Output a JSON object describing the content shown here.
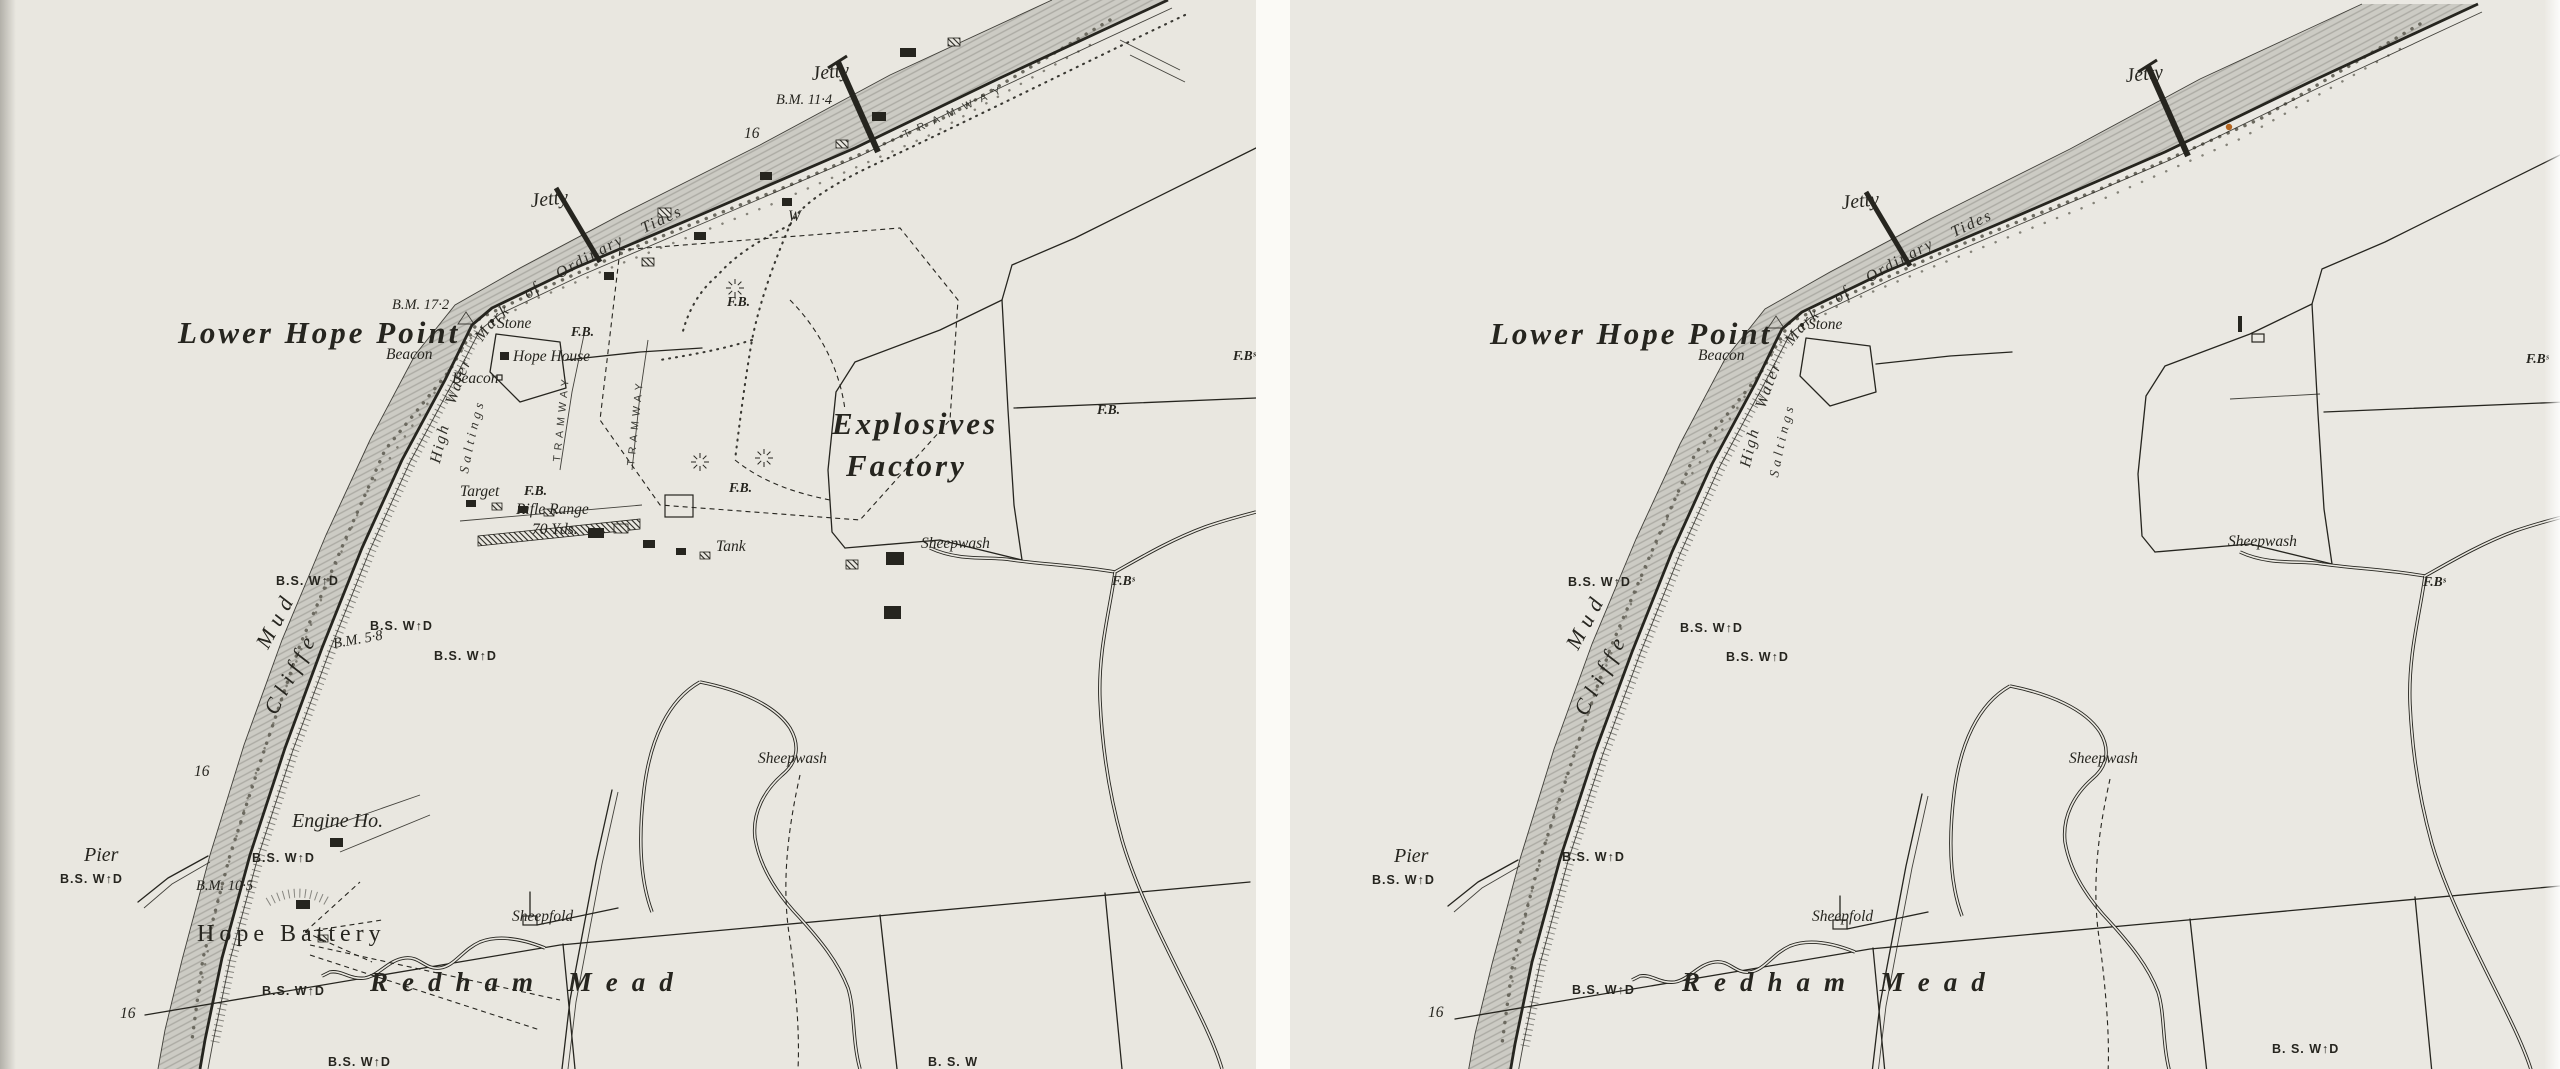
{
  "colors": {
    "paper": "#e9e7e0",
    "ink": "#26251f",
    "gutter": "#fbfaf6",
    "waterfill": "#c9c8c1",
    "waterhatch": "#a5a49d",
    "stipple": "#6b695f",
    "fleck": "#b4651f"
  },
  "common": {
    "hwm_text": "High Water Mark of Ordinary Tides",
    "saltings_text": "Saltings"
  },
  "panels": [
    {
      "name": "map-original",
      "labels": [
        {
          "t": "Jetty",
          "x": 812,
          "y": 80,
          "c": "it-md",
          "r": -6
        },
        {
          "t": "B.M. 11·4",
          "x": 776,
          "y": 104,
          "c": "bm"
        },
        {
          "t": "TRAMWAY",
          "x": 905,
          "y": 138,
          "c": "tram",
          "r": -25,
          "ls": 9
        },
        {
          "t": "16",
          "x": 744,
          "y": 138,
          "c": "it-sm"
        },
        {
          "t": "Jetty",
          "x": 531,
          "y": 207,
          "c": "it-md",
          "r": -6
        },
        {
          "t": "B.M. 17·2",
          "x": 392,
          "y": 309,
          "c": "bm"
        },
        {
          "t": "Lower Hope Point",
          "x": 178,
          "y": 343,
          "c": "place-lg"
        },
        {
          "t": "Beacon",
          "x": 386,
          "y": 359,
          "c": "it-sm"
        },
        {
          "t": "Stone",
          "x": 497,
          "y": 328,
          "c": "it-sm"
        },
        {
          "t": "Hope House",
          "x": 513,
          "y": 361,
          "c": "it-sm"
        },
        {
          "t": "Beacon",
          "x": 452,
          "y": 383,
          "c": "it-sm"
        },
        {
          "t": "F.B.",
          "x": 571,
          "y": 336,
          "c": "fb"
        },
        {
          "t": "F.B.",
          "x": 727,
          "y": 306,
          "c": "fb"
        },
        {
          "t": "W",
          "x": 788,
          "y": 221,
          "c": "it-sm"
        },
        {
          "t": "TRAMWAY",
          "x": 560,
          "y": 462,
          "c": "tram",
          "r": -84,
          "ls": 5
        },
        {
          "t": "TRAMWAY",
          "x": 634,
          "y": 466,
          "c": "tram",
          "r": -84,
          "ls": 5
        },
        {
          "t": "Explosives",
          "x": 832,
          "y": 434,
          "c": "place-lg"
        },
        {
          "t": "Factory",
          "x": 846,
          "y": 476,
          "c": "place-lg"
        },
        {
          "t": "Target",
          "x": 460,
          "y": 496,
          "c": "it-sm"
        },
        {
          "t": "F.B.",
          "x": 524,
          "y": 495,
          "c": "fb"
        },
        {
          "t": "Rifle Range",
          "x": 516,
          "y": 514,
          "c": "it-sm"
        },
        {
          "t": "70 Yds.",
          "x": 532,
          "y": 534,
          "c": "it-sm"
        },
        {
          "t": "F.B.",
          "x": 729,
          "y": 492,
          "c": "fb"
        },
        {
          "t": "Tank",
          "x": 716,
          "y": 551,
          "c": "it-sm"
        },
        {
          "t": "Sheepwash",
          "x": 921,
          "y": 548,
          "c": "it-sm"
        },
        {
          "t": "F.B.",
          "x": 1097,
          "y": 414,
          "c": "fb"
        },
        {
          "t": "F.Bˢ",
          "x": 1233,
          "y": 360,
          "c": "fb"
        },
        {
          "t": "F.Bˢ",
          "x": 1112,
          "y": 585,
          "c": "fb"
        },
        {
          "t": "B.S. W↑D",
          "x": 276,
          "y": 585,
          "c": "bs"
        },
        {
          "t": "B.S. W↑D",
          "x": 370,
          "y": 630,
          "c": "bs"
        },
        {
          "t": "B.M. 5·8",
          "x": 334,
          "y": 648,
          "c": "bm",
          "r": -10
        },
        {
          "t": "B.S. W↑D",
          "x": 434,
          "y": 660,
          "c": "bs"
        },
        {
          "t": "Mud",
          "x": 268,
          "y": 650,
          "c": "it-lg",
          "r": -62
        },
        {
          "t": "Cliffe",
          "x": 276,
          "y": 716,
          "c": "it-lg",
          "r": -62
        },
        {
          "t": "16",
          "x": 194,
          "y": 776,
          "c": "it-sm"
        },
        {
          "t": "Engine Ho.",
          "x": 292,
          "y": 827,
          "c": "it-md"
        },
        {
          "t": "Pier",
          "x": 84,
          "y": 861,
          "c": "it-md"
        },
        {
          "t": "B.S. W↑D",
          "x": 60,
          "y": 883,
          "c": "bs"
        },
        {
          "t": "B.S. W↑D",
          "x": 252,
          "y": 862,
          "c": "bs"
        },
        {
          "t": "B.M. 10·5",
          "x": 196,
          "y": 890,
          "c": "bm"
        },
        {
          "t": "Hope Battery",
          "x": 197,
          "y": 941,
          "c": "serif-md"
        },
        {
          "t": "B.S. W↑D",
          "x": 262,
          "y": 995,
          "c": "bs"
        },
        {
          "t": "16",
          "x": 120,
          "y": 1018,
          "c": "it-sm"
        },
        {
          "t": "B.S. W↑D",
          "x": 328,
          "y": 1066,
          "c": "bs"
        },
        {
          "t": "Sheepfold",
          "x": 512,
          "y": 921,
          "c": "it-sm"
        },
        {
          "t": "Redham Mead",
          "x": 370,
          "y": 991,
          "c": "mead",
          "ls": 14
        },
        {
          "t": "Sheepwash",
          "x": 758,
          "y": 763,
          "c": "it-sm"
        },
        {
          "t": "B. S. W",
          "x": 928,
          "y": 1066,
          "c": "bs"
        }
      ]
    },
    {
      "name": "map-censored",
      "labels": [
        {
          "t": "Jetty",
          "x": 836,
          "y": 82,
          "c": "it-md",
          "r": -6
        },
        {
          "t": "Jetty",
          "x": 552,
          "y": 209,
          "c": "it-md",
          "r": -6
        },
        {
          "t": "Lower Hope Point",
          "x": 200,
          "y": 344,
          "c": "place-lg"
        },
        {
          "t": "Beacon",
          "x": 408,
          "y": 360,
          "c": "it-sm"
        },
        {
          "t": "Stone",
          "x": 518,
          "y": 329,
          "c": "it-sm"
        },
        {
          "t": "Sheepwash",
          "x": 938,
          "y": 546,
          "c": "it-sm"
        },
        {
          "t": "F.Bˢ",
          "x": 1133,
          "y": 586,
          "c": "fb"
        },
        {
          "t": "F.Bˢ",
          "x": 1236,
          "y": 363,
          "c": "fb"
        },
        {
          "t": "B.S. W↑D",
          "x": 278,
          "y": 586,
          "c": "bs"
        },
        {
          "t": "B.S. W↑D",
          "x": 390,
          "y": 632,
          "c": "bs"
        },
        {
          "t": "B.S. W↑D",
          "x": 436,
          "y": 661,
          "c": "bs"
        },
        {
          "t": "Mud",
          "x": 288,
          "y": 651,
          "c": "it-lg",
          "r": -62
        },
        {
          "t": "Cliffe",
          "x": 296,
          "y": 717,
          "c": "it-lg",
          "r": -62
        },
        {
          "t": "Pier",
          "x": 104,
          "y": 862,
          "c": "it-md"
        },
        {
          "t": "B.S. W↑D",
          "x": 82,
          "y": 884,
          "c": "bs"
        },
        {
          "t": "B.S. W↑D",
          "x": 272,
          "y": 861,
          "c": "bs"
        },
        {
          "t": "B.S. W↑D",
          "x": 282,
          "y": 994,
          "c": "bs"
        },
        {
          "t": "16",
          "x": 138,
          "y": 1017,
          "c": "it-sm"
        },
        {
          "t": "Sheepfold",
          "x": 522,
          "y": 921,
          "c": "it-sm"
        },
        {
          "t": "Redham Mead",
          "x": 392,
          "y": 991,
          "c": "mead",
          "ls": 14
        },
        {
          "t": "Sheepwash",
          "x": 779,
          "y": 763,
          "c": "it-sm"
        },
        {
          "t": "B. S. W↑D",
          "x": 982,
          "y": 1053,
          "c": "bs"
        }
      ],
      "fleck": {
        "x": 939,
        "y": 127
      }
    }
  ]
}
